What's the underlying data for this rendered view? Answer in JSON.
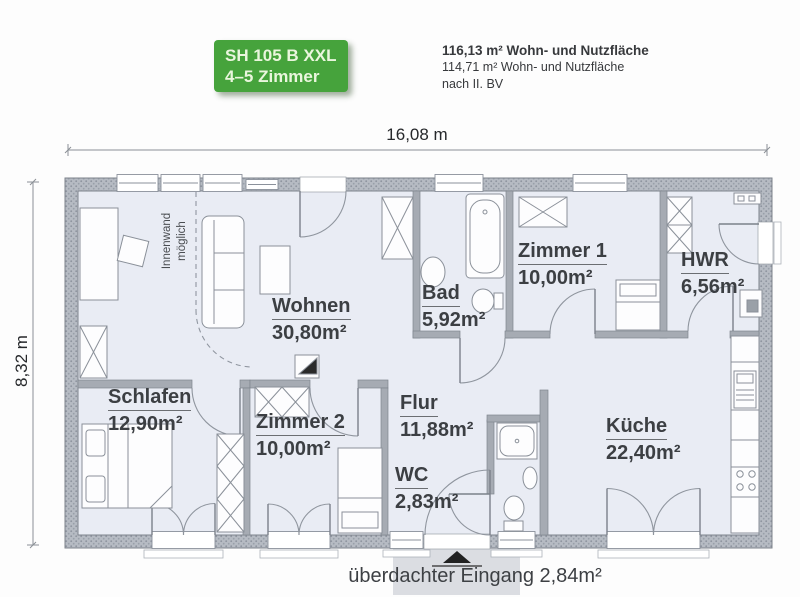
{
  "header": {
    "badge": {
      "line1": "SH 105 B XXL",
      "line2": "4–5 Zimmer"
    },
    "area_info": {
      "line1": "116,13 m² Wohn- und Nutzfläche",
      "line2": "114,71 m² Wohn- und Nutzfläche",
      "line3": "nach II. BV"
    }
  },
  "dimensions": {
    "width": "16,08 m",
    "height": "8,32 m"
  },
  "rooms": [
    {
      "id": "wohnen",
      "name": "Wohnen",
      "area": "30,80m²"
    },
    {
      "id": "bad",
      "name": "Bad",
      "area": "5,92m²"
    },
    {
      "id": "zimmer1",
      "name": "Zimmer 1",
      "area": "10,00m²"
    },
    {
      "id": "hwr",
      "name": "HWR",
      "area": "6,56m²"
    },
    {
      "id": "schlafen",
      "name": "Schlafen",
      "area": "12,90m²"
    },
    {
      "id": "zimmer2",
      "name": "Zimmer 2",
      "area": "10,00m²"
    },
    {
      "id": "flur",
      "name": "Flur",
      "area": "11,88m²"
    },
    {
      "id": "wc",
      "name": "WC",
      "area": "2,83m²"
    },
    {
      "id": "kueche",
      "name": "Küche",
      "area": "22,40m²"
    }
  ],
  "annotations": {
    "inner_wall_line1": "Innenwand",
    "inner_wall_line2": "möglich",
    "entrance": "überdachter Eingang 2,84m²"
  },
  "colors": {
    "accent_green": "#46a33c",
    "floor": "#e9ecf4",
    "wall_gray": "#b6bbc3",
    "label_text": "#3c3f43"
  }
}
